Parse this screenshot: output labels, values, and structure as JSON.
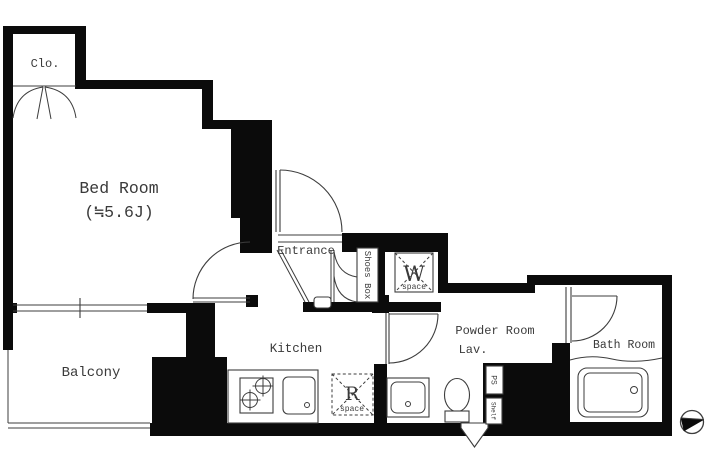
{
  "document": {
    "kind": "apartment-floor-plan",
    "background": "#ffffff"
  },
  "rooms": {
    "closet": {
      "label": "Clo."
    },
    "bedroom": {
      "label": "Bed Room",
      "size": "(≒5.6J)"
    },
    "entrance": {
      "label": "Entrance"
    },
    "shoes_box": {
      "label": "Shoes Box"
    },
    "washer_space": {
      "letter": "W",
      "label": "space"
    },
    "kitchen": {
      "label": "Kitchen"
    },
    "refrigerator_space": {
      "letter": "R",
      "label": "space"
    },
    "powder_room": {
      "label": "Powder Room",
      "sublabel": "Lav."
    },
    "bath_room": {
      "label": "Bath Room"
    },
    "balcony": {
      "label": "Balcony"
    },
    "pipe_space": {
      "label": "PS"
    },
    "shelf": {
      "label": "Shelf"
    }
  },
  "icons": {
    "north_indicator": "compass-icon"
  },
  "colors": {
    "wall": "#0b0b0b",
    "line": "#3d3d3d",
    "text": "#3a3a3a",
    "background": "#ffffff"
  }
}
